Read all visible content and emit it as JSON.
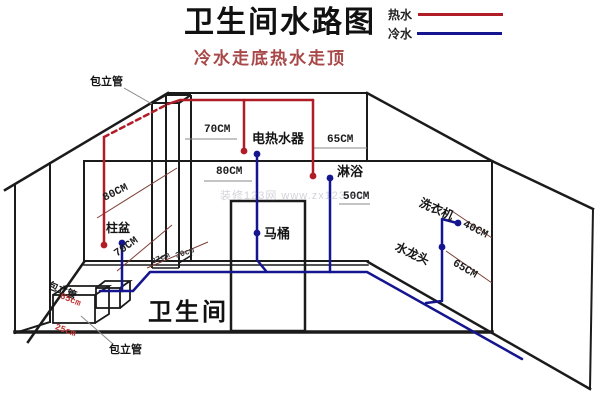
{
  "title": "卫生间水路图",
  "subtitle": "冷水走底热水走顶",
  "legend": {
    "hot": "热水",
    "cold": "冷水"
  },
  "colors": {
    "hot": "#b01d26",
    "cold": "#15158f",
    "wall": "#1b1b1b",
    "dim": "#8a8a8a",
    "dimred": "#7d4035",
    "subtitle": "#a84848"
  },
  "labels": {
    "duct_top": "包立管",
    "dim70_top": "70CM",
    "water_heater": "电热水器",
    "dim65_top": "65CM",
    "dim80_mid": "80CM",
    "shower": "淋浴",
    "dim50": "50CM",
    "toilet": "马桶",
    "basin": "柱盆",
    "dim80_left": "80CM",
    "dim70_left": "70CM",
    "dim37": "37cm",
    "dim30": "30cm",
    "washer": "洗衣机",
    "dim40": "40CM",
    "faucet": "水龙头",
    "dim65_right": "65CM",
    "duct_left": "包立管",
    "dim65_red": "65cm",
    "dim25_red": "25cm",
    "duct_bottom": "包立管",
    "room": "卫生间",
    "watermark": "装修123网 www.zx123.cn"
  }
}
